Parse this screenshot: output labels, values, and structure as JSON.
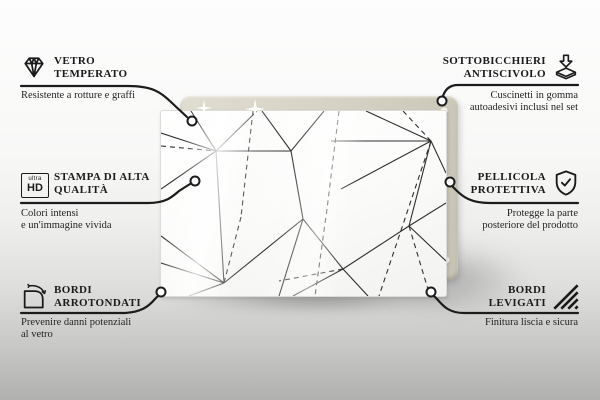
{
  "product": {
    "type": "decorative glass board with geometric triangle line pattern",
    "colors": {
      "backing_board": "#d6d3c4",
      "glass": "#fdfdfd",
      "pattern_line": "#2e2e2e",
      "text": "#1b1b1b",
      "background_bottom": "#b0b0af"
    }
  },
  "callouts": {
    "tempered_glass": {
      "icon": "diamond-icon",
      "title_line1": "VETRO",
      "title_line2": "TEMPERATO",
      "description": "Resistente a rotture e graffi"
    },
    "anti_slip": {
      "icon": "adhesive-pad-icon",
      "title_line1": "SOTTOBICCHIERI",
      "title_line2": "ANTISCIVOLO",
      "description_line1": "Cuscinetti in gomma",
      "description_line2": "autoadesivi inclusi nel set"
    },
    "print_quality": {
      "icon": "ultra-hd-badge-icon",
      "badge_top": "ultra",
      "badge_bottom": "HD",
      "title_line1": "STAMPA DI ALTA",
      "title_line2": "QUALITÀ",
      "description_line1": "Colori intensi",
      "description_line2": "e un'immagine vivida"
    },
    "protective_film": {
      "icon": "shield-check-icon",
      "title_line1": "PELLICOLA",
      "title_line2": "PROTETTIVA",
      "description_line1": "Protegge la parte",
      "description_line2": "posteriore del prodotto"
    },
    "rounded_edges": {
      "icon": "rounded-corner-icon",
      "title_line1": "BORDI",
      "title_line2": "ARROTONDATI",
      "description_line1": "Prevenire danni potenziali",
      "description_line2": "al vetro"
    },
    "polished_edges": {
      "icon": "hatched-edge-icon",
      "title_line1": "BORDI",
      "title_line2": "LEVIGATI",
      "description": "Finitura liscia e sicura"
    }
  }
}
